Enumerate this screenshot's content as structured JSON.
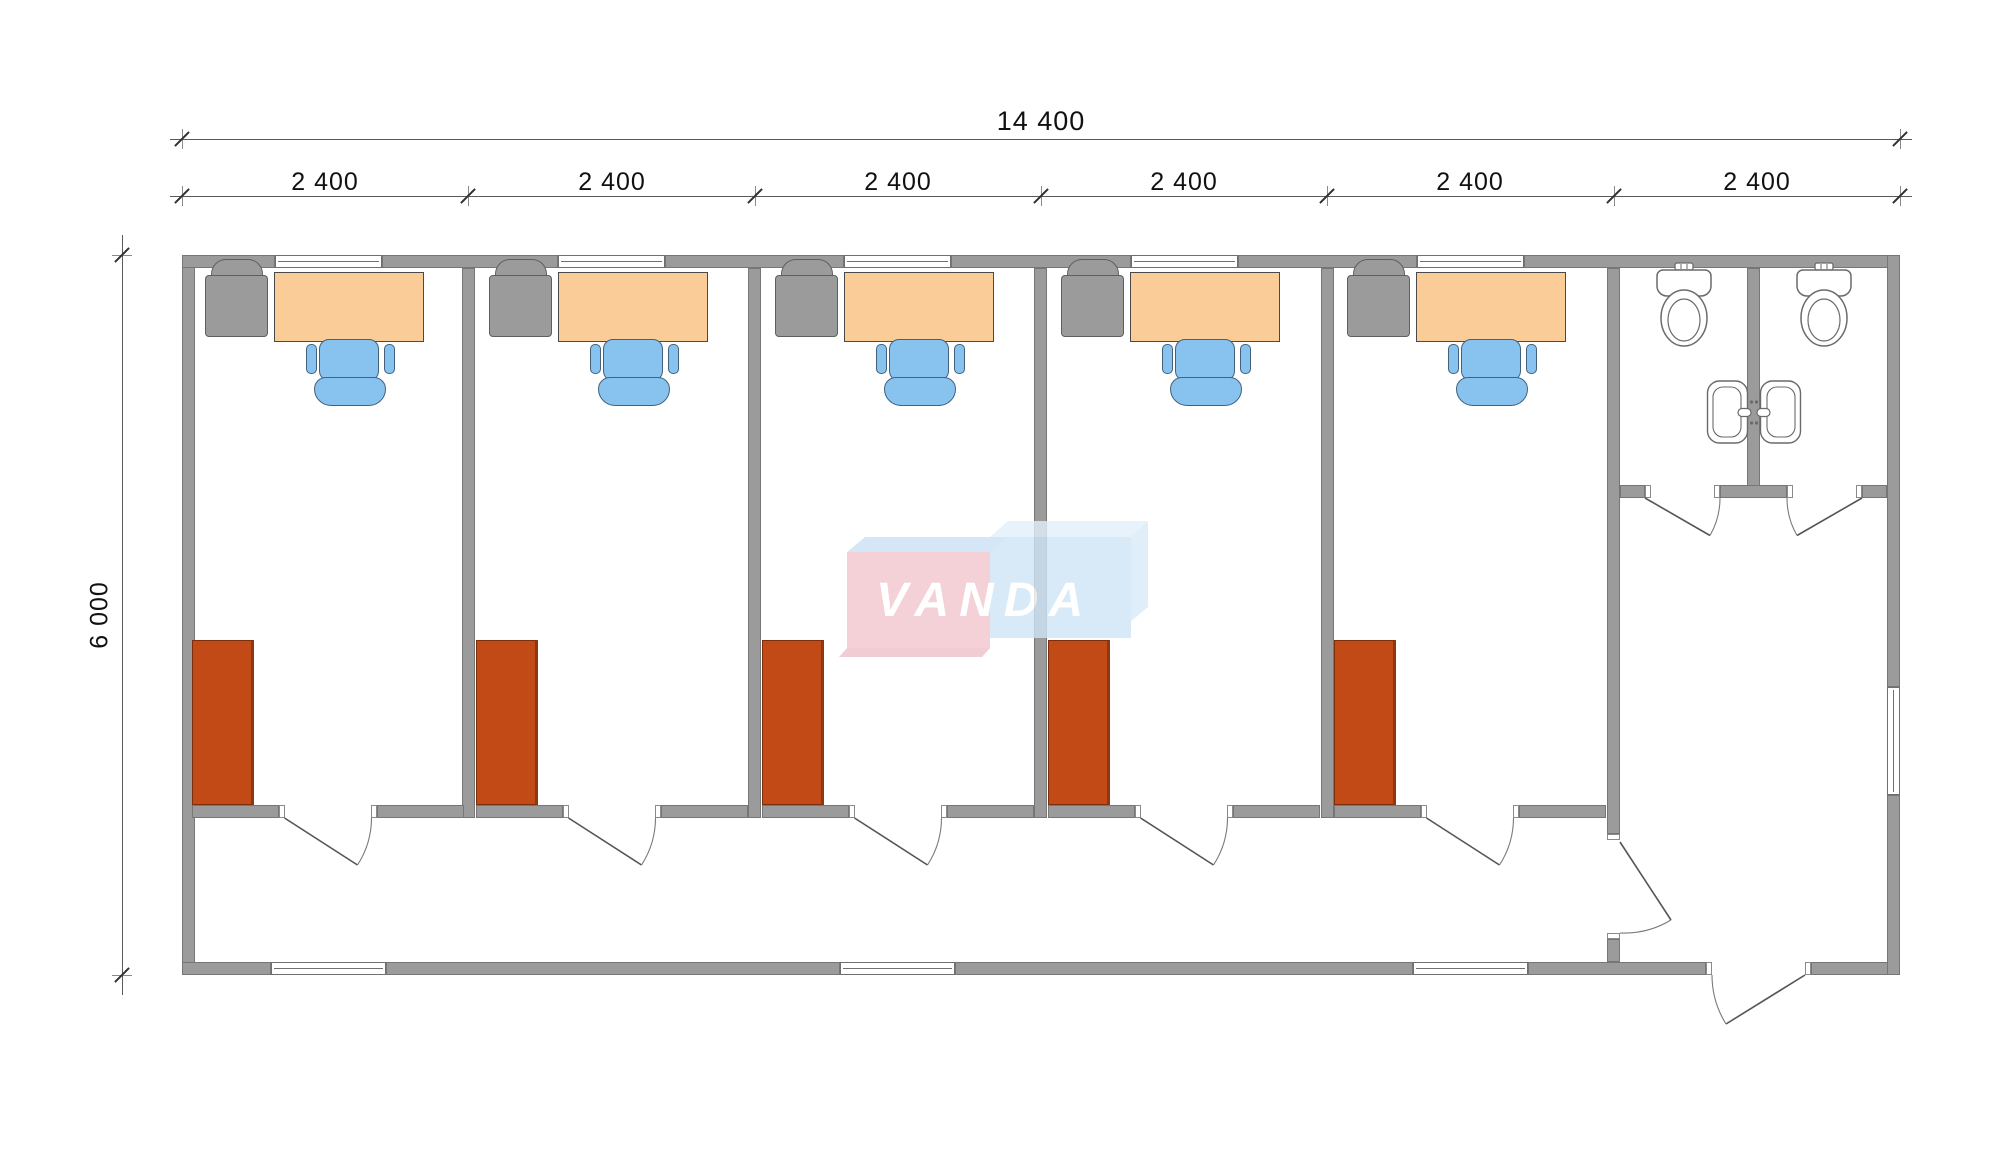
{
  "dimensions": {
    "total_width_label": "14 400",
    "module_width_label": "2 400",
    "total_depth_label": "6 000"
  },
  "watermark": {
    "text": "VANDA",
    "pink": "#F2C6CD",
    "light_blue": "#CFE5F7"
  },
  "colors": {
    "wall": "#9B9B9B",
    "desk": "#FACD98",
    "office_chair": "#88C2EF",
    "side_chair": "#9B9B9B",
    "wardrobe": "#C24A17"
  },
  "structure": {
    "office_rooms": 5,
    "toilet_stalls": 2,
    "desks": 5,
    "office_chairs": 5,
    "side_chairs": 5,
    "wardrobes": 5,
    "toilets": 2,
    "sinks": 2,
    "doors": 9,
    "windows": 9
  }
}
